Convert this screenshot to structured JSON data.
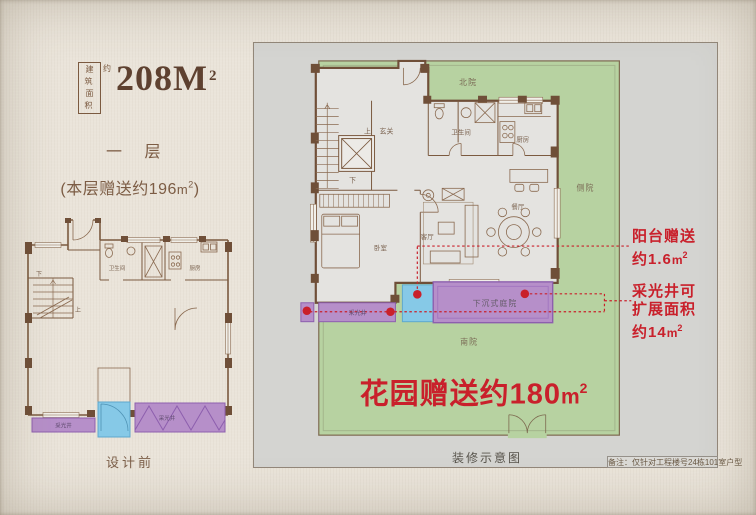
{
  "colors": {
    "accent_red": "#c9202b",
    "garden_green": "#b7d2a1",
    "courtyard_purple": "#b68fc9",
    "balcony_blue": "#86c9e7",
    "wall_brown": "#6f4f38",
    "text_brown": "#7c5c44",
    "panel_gray": "#d4d4d1",
    "page_beige": "#eae4da"
  },
  "header": {
    "area_box_row1": "建筑",
    "area_box_row2": "面积",
    "area_approx": "约",
    "area_value": "208M",
    "area_sup": "2",
    "floor_label": "一 层",
    "bonus_prefix": "(本层赠送约196",
    "bonus_unit": "m",
    "bonus_sup": "2",
    "bonus_suffix": ")"
  },
  "left_plan": {
    "caption": "设计前",
    "labels": {
      "down": "下",
      "up": "上",
      "bath": "卫生间",
      "kitchen": "厨房",
      "lightwell_left": "采光井",
      "lightwell_right": "采光井"
    }
  },
  "right_plan": {
    "caption": "装修示意图",
    "disclaimer": "备注：仅针对工程楼号24栋101室户型",
    "garden_gift": {
      "text": "花园赠送约180",
      "unit": "m",
      "sup": "2"
    },
    "yards": {
      "north": "北院",
      "side": "侧院",
      "south": "南院"
    },
    "rooms": {
      "up": "上",
      "entry": "玄关",
      "down": "下",
      "bath": "卫生间",
      "kitchen": "厨房",
      "dining": "餐厅",
      "living": "客厅",
      "bedroom": "卧室",
      "lightwell": "采光井",
      "sunken_courtyard": "下沉式庭院"
    },
    "notes": {
      "balcony": {
        "line1": "阳台赠送",
        "line2": "约1.6",
        "unit": "m",
        "sup": "2"
      },
      "lightwell": {
        "line1": "采光井可",
        "line2": "扩展面积",
        "line3": "约14",
        "unit": "m",
        "sup": "2"
      }
    }
  }
}
